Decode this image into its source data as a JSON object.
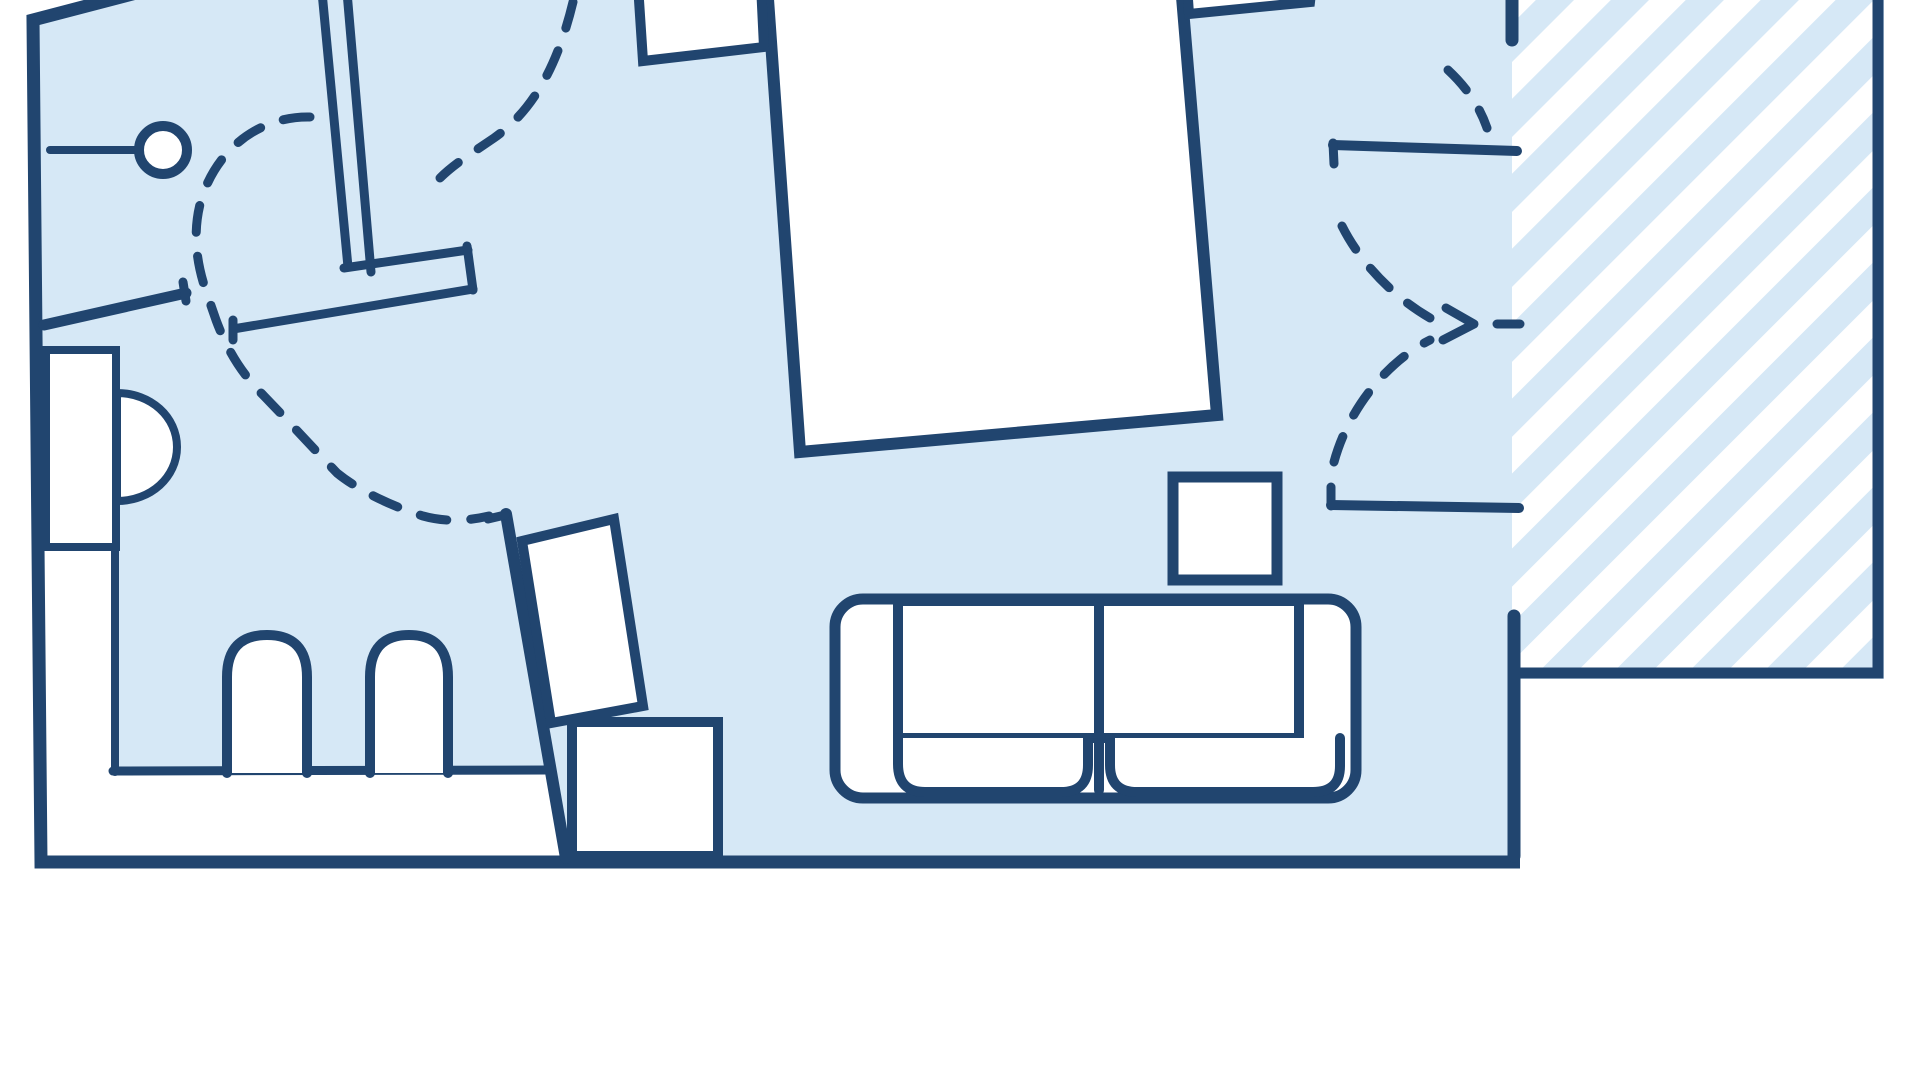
{
  "app": {
    "kind": "floor-plan-illustration",
    "visible_text": []
  },
  "palette": {
    "wall_color": "#21456F",
    "floor_color": "#D6E8F6",
    "furniture_fill": "#FFFFFF",
    "background": "#FFFFFF"
  },
  "canvas": {
    "width": 1920,
    "height": 1080,
    "view_box": "0 0 1920 1080"
  },
  "hatch": {
    "stripe_color": "#FFFFFF",
    "stripe_width": 26,
    "period": 53,
    "angle_deg": 45,
    "region": {
      "x": 1512,
      "y": -8,
      "width": 362,
      "height": 682
    }
  },
  "dash": {
    "pattern": "27 24"
  },
  "elements": [
    {
      "name": "floor-area",
      "tag": "polygon",
      "attrs": {
        "points": "140,-8 33,20 41,862 1520,862 1520,679 1884,679 1884,-8",
        "fill": "@floor",
        "stroke": "none"
      }
    },
    {
      "name": "balcony-floor-hatch",
      "tag": "rect",
      "attrs": {
        "x": 1512,
        "y": -8,
        "width": 362,
        "height": 682,
        "fill": "@hatch",
        "stroke": "none"
      }
    },
    {
      "name": "recess-left-area",
      "tag": "rect",
      "attrs": {
        "x": 40,
        "y": 545,
        "width": 77,
        "height": 330,
        "fill": "@bg",
        "stroke": "none"
      }
    },
    {
      "name": "dining-recess-area",
      "tag": "polygon",
      "attrs": {
        "points": "113,771 551,771 568,868 113,868",
        "fill": "@bg",
        "stroke": "none"
      }
    },
    {
      "name": "walk-path-entry",
      "tag": "path",
      "attrs": {
        "d": "M573,2 C558,64 534,110 494,138 C472,153 454,164 440,178",
        "fill": "none",
        "stroke": "@wall",
        "stroke-width": 9,
        "stroke-linecap": "round",
        "stroke-dasharray": "27 24"
      }
    },
    {
      "name": "walk-path-main",
      "tag": "path",
      "attrs": {
        "d": "M310,117 C266,116 222,142 203,194 C192,227 195,260 207,294 L216,320 C229,355 245,377 264,396 C292,425 314,449 337,473 C359,491 394,507 423,516 C448,523 472,520 489,516",
        "fill": "none",
        "stroke": "@wall",
        "stroke-width": 9,
        "stroke-linecap": "round",
        "stroke-dasharray": "27 24"
      }
    },
    {
      "name": "balcony-path-upper",
      "tag": "path",
      "attrs": {
        "d": "M1448,70 Q1476,96 1487,128",
        "fill": "none",
        "stroke": "@wall",
        "stroke-width": 9,
        "stroke-linecap": "round",
        "stroke-dasharray": "27 24"
      }
    },
    {
      "name": "balcony-path-mid",
      "tag": "path",
      "attrs": {
        "d": "M1342,226 C1360,262 1392,296 1430,318",
        "fill": "none",
        "stroke": "@wall",
        "stroke-width": 9,
        "stroke-linecap": "round",
        "stroke-dasharray": "27 24"
      }
    },
    {
      "name": "balcony-path-lower",
      "tag": "path",
      "attrs": {
        "d": "M1334,462 C1348,410 1386,362 1430,340",
        "fill": "none",
        "stroke": "@wall",
        "stroke-width": 9,
        "stroke-linecap": "round",
        "stroke-dasharray": "27 24"
      }
    },
    {
      "name": "balcony-arrowhead-icon",
      "tag": "polyline",
      "attrs": {
        "points": "1446,308 1474,324 1443,340",
        "fill": "none",
        "stroke": "@wall",
        "stroke-width": 9,
        "stroke-linecap": "round",
        "stroke-linejoin": "round"
      }
    },
    {
      "name": "balcony-door-dash",
      "tag": "line",
      "attrs": {
        "x1": 1497,
        "y1": 324,
        "x2": 1520,
        "y2": 324,
        "stroke": "@wall",
        "stroke-width": 9,
        "stroke-linecap": "round"
      }
    },
    {
      "name": "outer-wall-main",
      "tag": "path",
      "attrs": {
        "d": "M140,-8 L33,20 L41,862 L1520,862",
        "fill": "none",
        "stroke": "@wall",
        "stroke-width": 13,
        "stroke-linejoin": "miter",
        "stroke-linecap": "butt"
      }
    },
    {
      "name": "right-wall-upper",
      "tag": "line",
      "attrs": {
        "x1": 1512,
        "y1": -8,
        "x2": 1512,
        "y2": 40,
        "stroke": "@wall",
        "stroke-width": 13,
        "stroke-linecap": "round"
      }
    },
    {
      "name": "right-wall-lower",
      "tag": "line",
      "attrs": {
        "x1": 1514,
        "y1": 616,
        "x2": 1514,
        "y2": 856,
        "stroke": "@wall",
        "stroke-width": 13,
        "stroke-linecap": "round"
      }
    },
    {
      "name": "balcony-wall",
      "tag": "path",
      "attrs": {
        "d": "M1878,-8 L1878,673 L1512,673",
        "fill": "none",
        "stroke": "@wall",
        "stroke-width": 11,
        "stroke-linejoin": "miter",
        "stroke-linecap": "butt"
      }
    },
    {
      "name": "bathroom-wall-left",
      "tag": "line",
      "attrs": {
        "x1": 44,
        "y1": 325,
        "x2": 186,
        "y2": 293,
        "stroke": "@wall",
        "stroke-width": 11,
        "stroke-linecap": "round"
      }
    },
    {
      "name": "bathroom-wall-cap",
      "tag": "line",
      "attrs": {
        "x1": 186,
        "y1": 301,
        "x2": 183,
        "y2": 282,
        "stroke": "@wall",
        "stroke-width": 9,
        "stroke-linecap": "round"
      }
    },
    {
      "name": "partition-wall-a",
      "tag": "line",
      "attrs": {
        "x1": 322,
        "y1": -8,
        "x2": 348,
        "y2": 267,
        "stroke": "@wall",
        "stroke-width": 9,
        "stroke-linecap": "round"
      }
    },
    {
      "name": "partition-wall-b",
      "tag": "line",
      "attrs": {
        "x1": 347,
        "y1": -8,
        "x2": 371,
        "y2": 272,
        "stroke": "@wall",
        "stroke-width": 9,
        "stroke-linecap": "round"
      }
    },
    {
      "name": "hall-wall-top",
      "tag": "line",
      "attrs": {
        "x1": 344,
        "y1": 268,
        "x2": 468,
        "y2": 250,
        "stroke": "@wall",
        "stroke-width": 9,
        "stroke-linecap": "round"
      }
    },
    {
      "name": "hall-wall-cap",
      "tag": "line",
      "attrs": {
        "x1": 467,
        "y1": 246,
        "x2": 473,
        "y2": 290,
        "stroke": "@wall",
        "stroke-width": 9,
        "stroke-linecap": "round"
      }
    },
    {
      "name": "hall-wall-bottom",
      "tag": "line",
      "attrs": {
        "x1": 473,
        "y1": 289,
        "x2": 233,
        "y2": 329,
        "stroke": "@wall",
        "stroke-width": 9,
        "stroke-linecap": "round"
      }
    },
    {
      "name": "hall-door-jamb",
      "tag": "line",
      "attrs": {
        "x1": 233,
        "y1": 320,
        "x2": 233,
        "y2": 340,
        "stroke": "@wall",
        "stroke-width": 9,
        "stroke-linecap": "round"
      }
    },
    {
      "name": "slanted-wall",
      "tag": "line",
      "attrs": {
        "x1": 506,
        "y1": 514,
        "x2": 566,
        "y2": 858,
        "stroke": "@wall",
        "stroke-width": 12,
        "stroke-linecap": "round"
      }
    },
    {
      "name": "slanted-wall-tick",
      "tag": "line",
      "attrs": {
        "x1": 488,
        "y1": 519,
        "x2": 505,
        "y2": 515,
        "stroke": "@wall",
        "stroke-width": 9,
        "stroke-linecap": "round"
      }
    },
    {
      "name": "nook-wall-top",
      "tag": "line",
      "attrs": {
        "x1": 1333,
        "y1": 145,
        "x2": 1517,
        "y2": 151,
        "stroke": "@wall",
        "stroke-width": 10,
        "stroke-linecap": "round"
      }
    },
    {
      "name": "nook-jamb-top",
      "tag": "line",
      "attrs": {
        "x1": 1333,
        "y1": 143,
        "x2": 1334,
        "y2": 164,
        "stroke": "@wall",
        "stroke-width": 9,
        "stroke-linecap": "round"
      }
    },
    {
      "name": "nook-wall-bottom",
      "tag": "line",
      "attrs": {
        "x1": 1331,
        "y1": 505,
        "x2": 1519,
        "y2": 508,
        "stroke": "@wall",
        "stroke-width": 10,
        "stroke-linecap": "round"
      }
    },
    {
      "name": "nook-jamb-bottom",
      "tag": "line",
      "attrs": {
        "x1": 1331,
        "y1": 487,
        "x2": 1331,
        "y2": 506,
        "stroke": "@wall",
        "stroke-width": 9,
        "stroke-linecap": "round"
      }
    },
    {
      "name": "recess-divider-line",
      "tag": "line",
      "attrs": {
        "x1": 46,
        "y1": 545,
        "x2": 116,
        "y2": 545,
        "stroke": "@wall",
        "stroke-width": 8,
        "stroke-linecap": "round"
      }
    },
    {
      "name": "recess-edge-line",
      "tag": "line",
      "attrs": {
        "x1": 115,
        "y1": 545,
        "x2": 115,
        "y2": 772,
        "stroke": "@wall",
        "stroke-width": 8,
        "stroke-linecap": "round"
      }
    },
    {
      "name": "bench-edge-line",
      "tag": "line",
      "attrs": {
        "x1": 113,
        "y1": 771,
        "x2": 549,
        "y2": 770,
        "stroke": "@wall",
        "stroke-width": 9,
        "stroke-linecap": "round"
      }
    },
    {
      "name": "wall-fixture-line",
      "tag": "line",
      "attrs": {
        "x1": 50,
        "y1": 150,
        "x2": 163,
        "y2": 150,
        "stroke": "@wall",
        "stroke-width": 8,
        "stroke-linecap": "round"
      }
    },
    {
      "name": "wall-fixture-circle",
      "tag": "circle",
      "attrs": {
        "cx": 163,
        "cy": 150,
        "r": 24,
        "fill": "@fill",
        "stroke": "@wall",
        "stroke-width": 10
      }
    },
    {
      "name": "kitchen-counter",
      "tag": "rect",
      "attrs": {
        "x": 46,
        "y": 350,
        "width": 70,
        "height": 197,
        "fill": "@fill",
        "stroke": "@wall",
        "stroke-width": 8
      }
    },
    {
      "name": "kitchen-sink",
      "tag": "path",
      "attrs": {
        "d": "M117,393 C151,393 177,417 177,447 C177,477 151,501 117,501 Z",
        "fill": "@fill",
        "stroke": "@wall",
        "stroke-width": 8
      }
    },
    {
      "name": "chair-arch-1",
      "tag": "path",
      "attrs": {
        "d": "M227,773 L227,677 Q227,635 267,635 Q307,635 307,677 L307,773",
        "fill": "@fill",
        "stroke": "@wall",
        "stroke-width": 10,
        "stroke-linecap": "round"
      }
    },
    {
      "name": "chair-arch-2",
      "tag": "path",
      "attrs": {
        "d": "M370,773 L370,677 Q370,635 409,635 Q448,635 448,677 L448,773",
        "fill": "@fill",
        "stroke": "@wall",
        "stroke-width": 10,
        "stroke-linecap": "round"
      }
    },
    {
      "name": "tilted-desk",
      "tag": "polygon",
      "attrs": {
        "points": "522,541 614,519 643,706 551,723",
        "fill": "@fill",
        "stroke": "@wall",
        "stroke-width": 10,
        "stroke-linejoin": "miter"
      }
    },
    {
      "name": "bottom-cabinet",
      "tag": "rect",
      "attrs": {
        "x": 572,
        "y": 722,
        "width": 146,
        "height": 134,
        "fill": "@fill",
        "stroke": "@wall",
        "stroke-width": 10
      }
    },
    {
      "name": "bed",
      "tag": "polygon",
      "attrs": {
        "points": "767,-15 1181,-15 1217,415 800,452",
        "fill": "@fill",
        "stroke": "@wall",
        "stroke-width": 12,
        "stroke-linejoin": "miter"
      }
    },
    {
      "name": "nightstand-left",
      "tag": "polygon",
      "attrs": {
        "points": "638,-15 761,-15 764,47 643,61",
        "fill": "@fill",
        "stroke": "@wall",
        "stroke-width": 10,
        "stroke-linejoin": "miter"
      }
    },
    {
      "name": "nightstand-right",
      "tag": "polygon",
      "attrs": {
        "points": "1187,-15 1312,-15 1310,2 1189,14",
        "fill": "@fill",
        "stroke": "@wall",
        "stroke-width": 10,
        "stroke-linejoin": "miter"
      }
    },
    {
      "name": "side-table",
      "tag": "rect",
      "attrs": {
        "x": 1173,
        "y": 477,
        "width": 104,
        "height": 103,
        "fill": "@fill",
        "stroke": "@wall",
        "stroke-width": 11
      }
    },
    {
      "name": "sofa-body",
      "tag": "rect",
      "attrs": {
        "x": 835,
        "y": 599,
        "width": 521,
        "height": 199,
        "rx": 28,
        "fill": "@fill",
        "stroke": "@wall",
        "stroke-width": 11
      }
    },
    {
      "name": "sofa-back-rect",
      "tag": "rect",
      "attrs": {
        "x": 898,
        "y": 601,
        "width": 401,
        "height": 137,
        "fill": "@fill",
        "stroke": "@wall",
        "stroke-width": 10
      }
    },
    {
      "name": "sofa-divider",
      "tag": "line",
      "attrs": {
        "x1": 1099,
        "y1": 601,
        "x2": 1099,
        "y2": 790,
        "stroke": "@wall",
        "stroke-width": 10,
        "stroke-linecap": "round"
      }
    },
    {
      "name": "sofa-cushion-left",
      "tag": "path",
      "attrs": {
        "d": "M898,738 L898,764 Q898,792 925,792 L1061,792 Q1088,792 1088,765 L1088,738",
        "fill": "@fill",
        "stroke": "@wall",
        "stroke-width": 10,
        "stroke-linecap": "round"
      }
    },
    {
      "name": "sofa-cushion-right",
      "tag": "path",
      "attrs": {
        "d": "M1110,738 L1110,765 Q1110,792 1137,792 L1313,792 Q1340,792 1340,766 L1340,738",
        "fill": "@fill",
        "stroke": "@wall",
        "stroke-width": 10,
        "stroke-linecap": "round"
      }
    }
  ]
}
